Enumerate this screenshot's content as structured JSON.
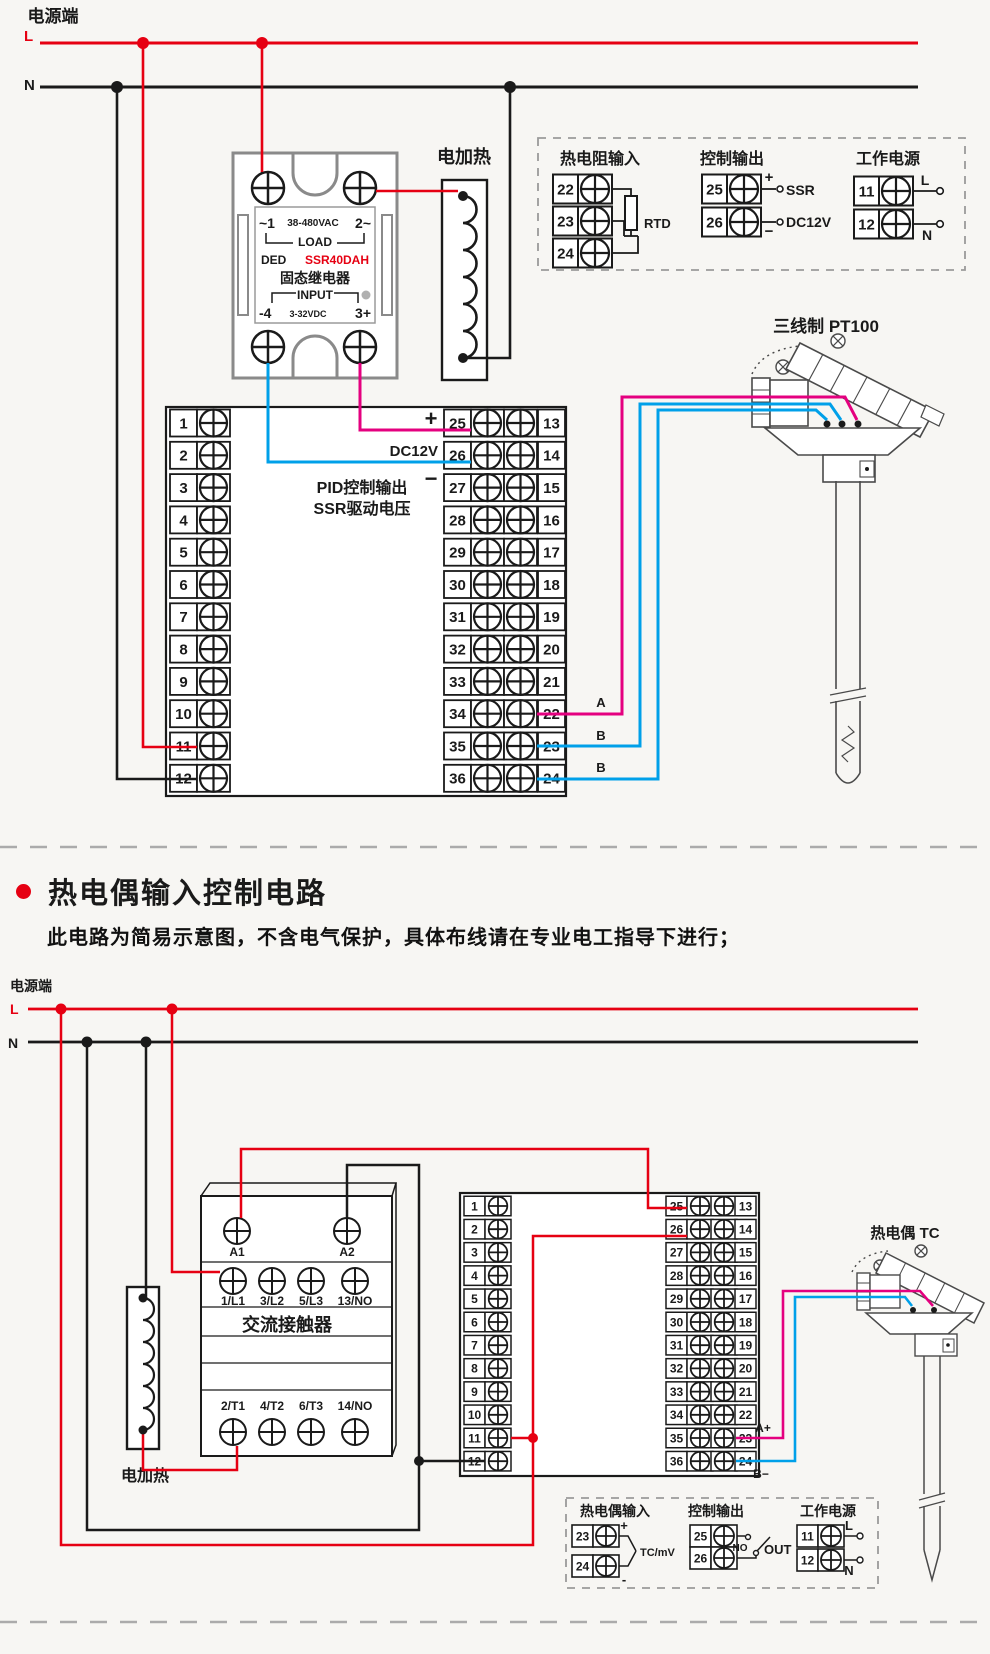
{
  "colors": {
    "wire_live": "#e60012",
    "wire_neutral": "#1a1a1a",
    "wire_pink": "#e4007f",
    "wire_blue": "#00a0e9",
    "outline_gray": "#8a8a8a",
    "dashed_gray": "#9a9a9a"
  },
  "top": {
    "power_label": "电源端",
    "live_label": "L",
    "neutral_label": "N",
    "heater_label": "电加热",
    "ssr": {
      "terminal_1": "~1",
      "voltage": "38-480VAC",
      "terminal_2": "2~",
      "load": "LOAD",
      "brand": "DED",
      "model": "SSR40DAH",
      "name": "固态继电器",
      "input": "INPUT",
      "terminal_4": "-4",
      "input_voltage": "3-32VDC",
      "terminal_3": "3+"
    },
    "conn_box": {
      "rtd_title": "热电阻输入",
      "rtd_terminals": [
        "22",
        "23",
        "24"
      ],
      "rtd_label": "RTD",
      "out_title": "控制输出",
      "out_terminals": [
        "25",
        "26"
      ],
      "out_plus": "+",
      "out_minus": "−",
      "out_ssr": "SSR",
      "out_dc12v": "DC12V",
      "pwr_title": "工作电源",
      "pwr_terminals": [
        "11",
        "12"
      ],
      "pwr_l": "L",
      "pwr_n": "N"
    },
    "controller": {
      "left_terminals": [
        "1",
        "2",
        "3",
        "4",
        "5",
        "6",
        "7",
        "8",
        "9",
        "10",
        "11",
        "12"
      ],
      "mid_terminals": [
        "25",
        "26",
        "27",
        "28",
        "29",
        "30",
        "31",
        "32",
        "33",
        "34",
        "35",
        "36"
      ],
      "right_terminals": [
        "13",
        "14",
        "15",
        "16",
        "17",
        "18",
        "19",
        "20",
        "21",
        "22",
        "23",
        "24"
      ],
      "plus": "+",
      "dc12v": "DC12V",
      "minus": "−",
      "pid_line1": "PID控制输出",
      "pid_line2": "SSR驱动电压",
      "wire_labels": [
        "A",
        "B",
        "B"
      ]
    },
    "sensor_title": "三线制 PT100"
  },
  "heading": {
    "title": "热电偶输入控制电路",
    "subtitle": "此电路为简易示意图，不含电气保护，具体布线请在专业电工指导下进行；"
  },
  "bottom": {
    "power_label": "电源端",
    "live_label": "L",
    "neutral_label": "N",
    "heater_label": "电加热",
    "contactor": {
      "coil_terminals": [
        "A1",
        "A2"
      ],
      "input_terminals": [
        "1/L1",
        "3/L2",
        "5/L3",
        "13/NO"
      ],
      "name": "交流接触器",
      "output_terminals": [
        "2/T1",
        "4/T2",
        "6/T3",
        "14/NO"
      ]
    },
    "controller": {
      "left_terminals": [
        "1",
        "2",
        "3",
        "4",
        "5",
        "6",
        "7",
        "8",
        "9",
        "10",
        "11",
        "12"
      ],
      "mid_terminals": [
        "25",
        "26",
        "27",
        "28",
        "29",
        "30",
        "31",
        "32",
        "33",
        "34",
        "35",
        "36"
      ],
      "right_terminals": [
        "13",
        "14",
        "15",
        "16",
        "17",
        "18",
        "19",
        "20",
        "21",
        "22",
        "23",
        "24"
      ],
      "wire_labels": [
        "A+",
        "B−"
      ]
    },
    "sensor_title": "热电偶 TC",
    "conn_box": {
      "tc_title": "热电偶输入",
      "tc_terminals": [
        "23",
        "24"
      ],
      "tc_plus": "+",
      "tc_minus": "-",
      "tc_label": "TC/mV",
      "out_title": "控制输出",
      "out_terminals": [
        "25",
        "26"
      ],
      "out_no": "NO",
      "out_label": "OUT",
      "pwr_title": "工作电源",
      "pwr_terminals": [
        "11",
        "12"
      ],
      "pwr_l": "L",
      "pwr_n": "N"
    }
  }
}
